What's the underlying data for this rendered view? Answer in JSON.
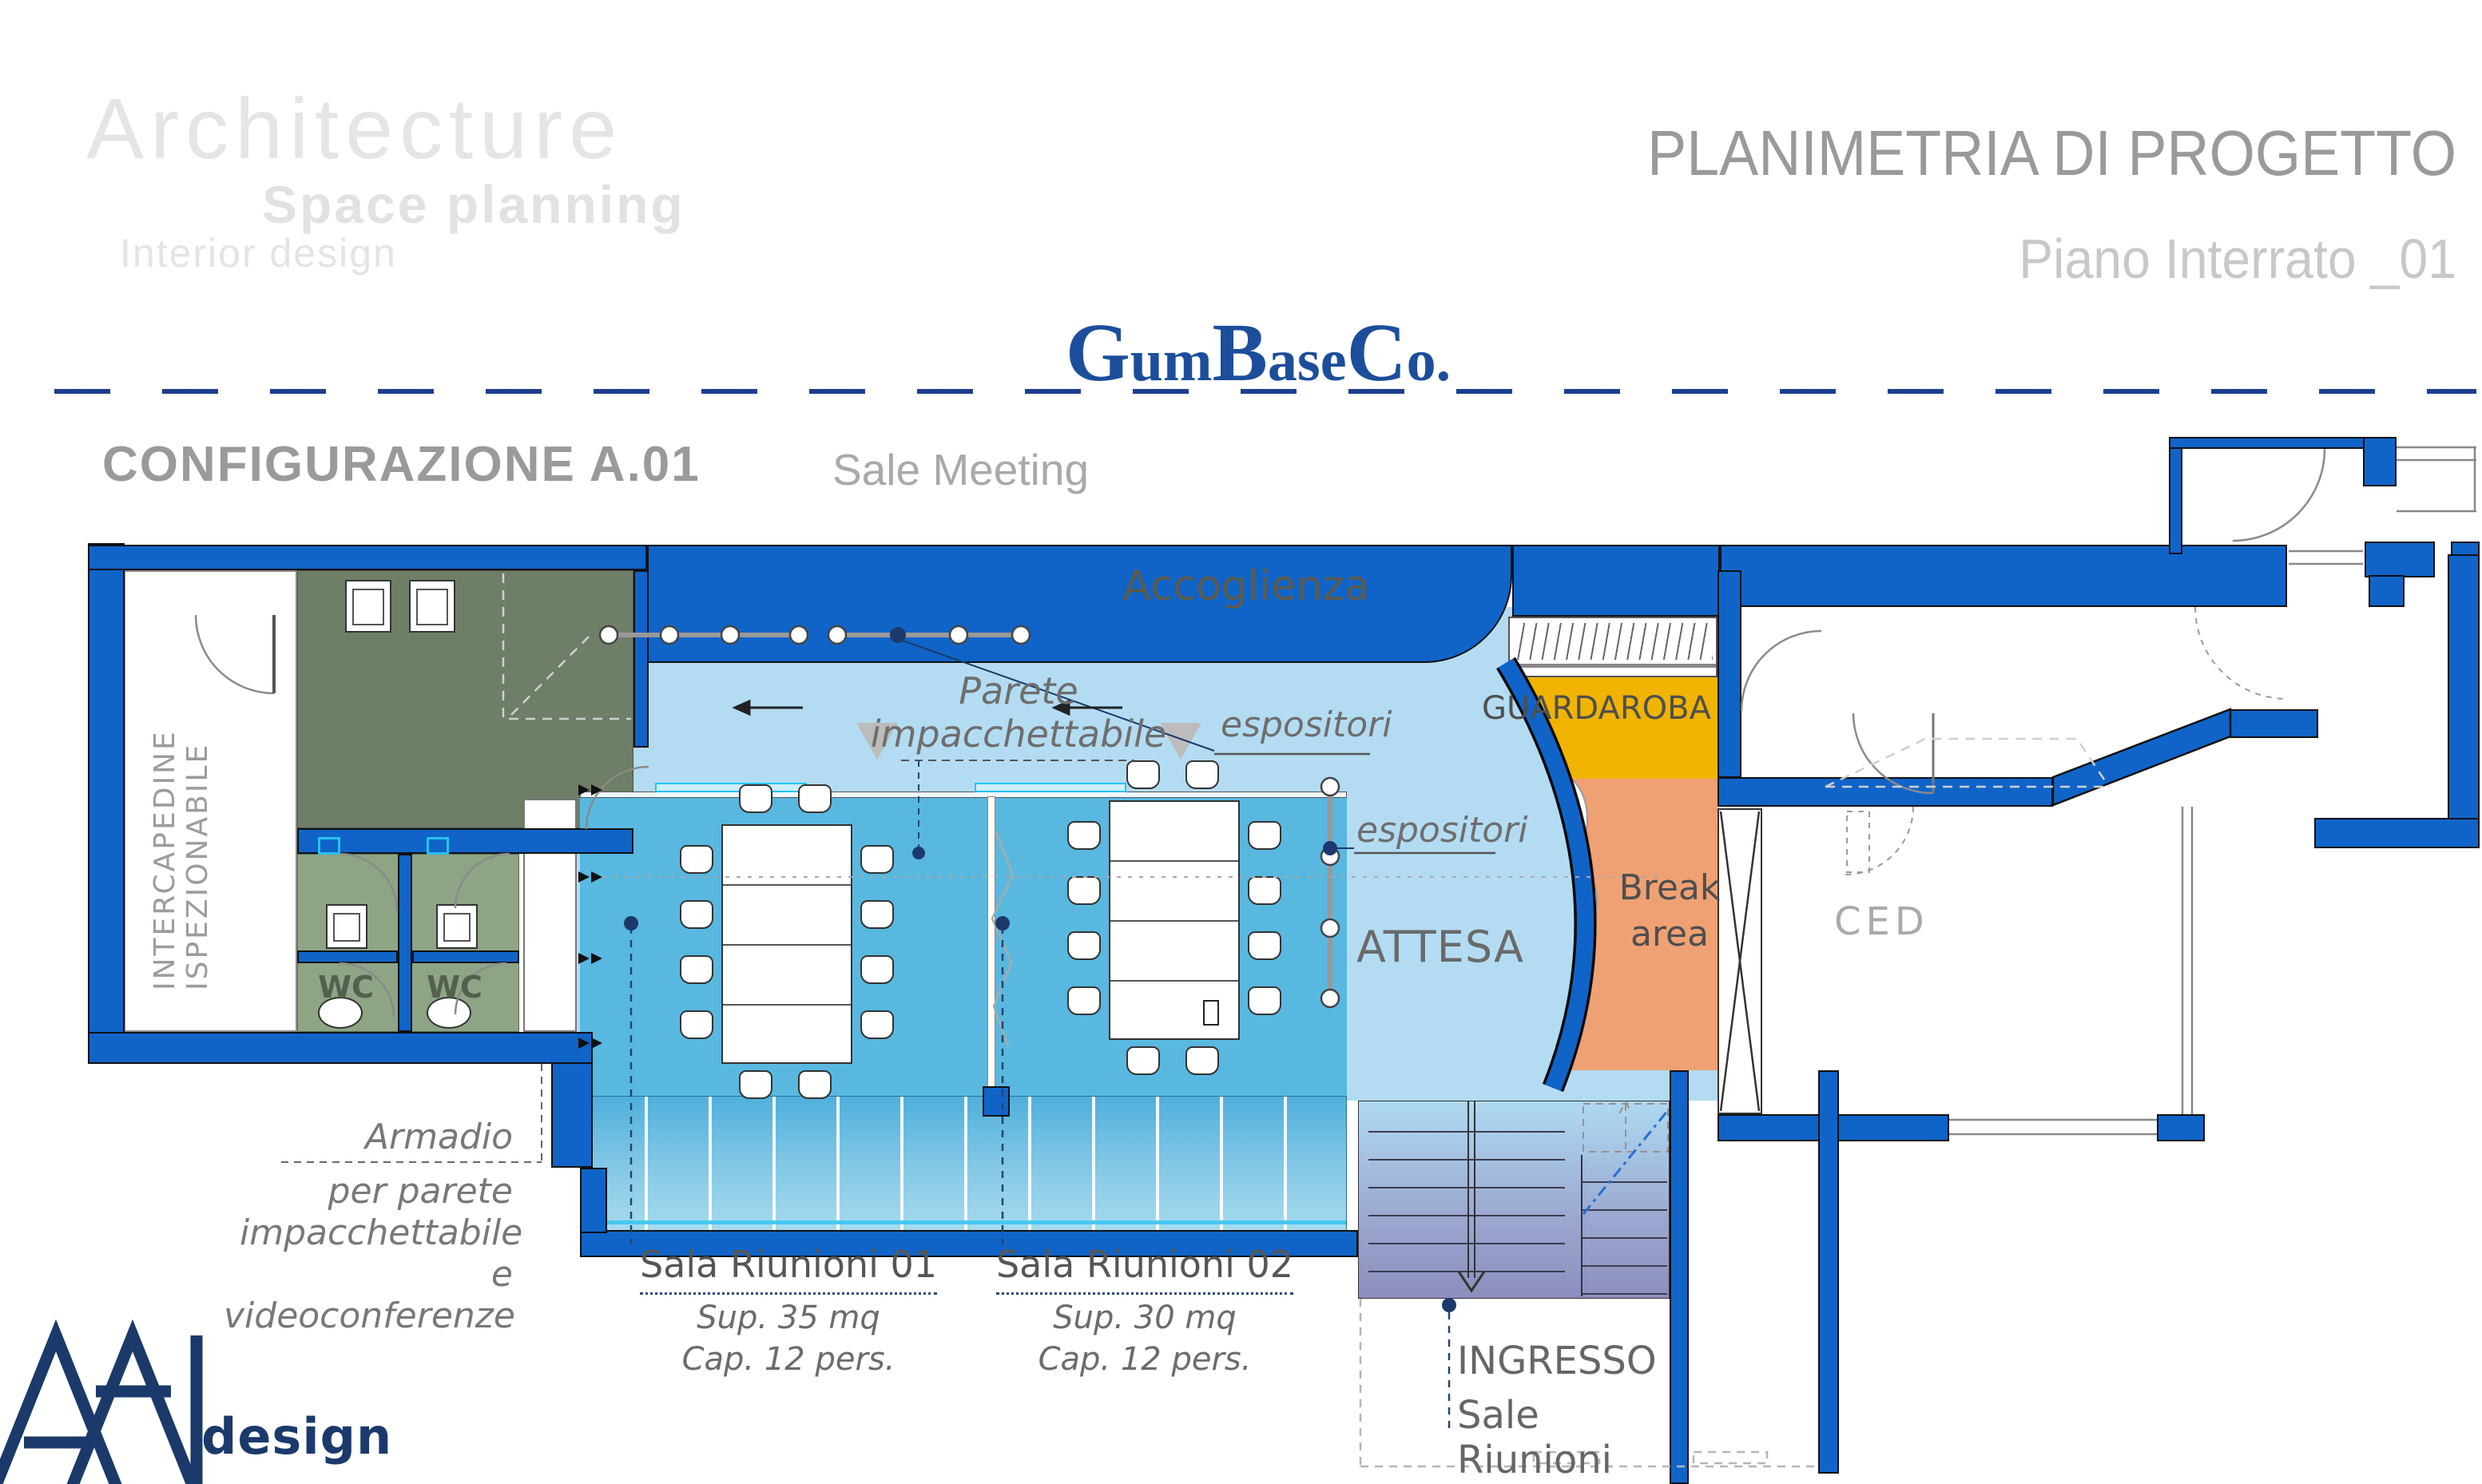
{
  "header": {
    "watermark": {
      "line1": "Architecture",
      "line2": "Space planning",
      "line3": "Interior design"
    },
    "title": "PLANIMETRIA DI PROGETTO",
    "subtitle": "Piano Interrato _01",
    "logo": {
      "p1": "G",
      "p2": "um",
      "p3": "B",
      "p4": "ase",
      "p5": "C",
      "p6": "o."
    },
    "config_code": "CONFIGURAZIONE A.01",
    "config_name": "Sale Meeting"
  },
  "plan": {
    "rooms": {
      "accoglienza": "Accoglienza",
      "intercapedine_line1": "INTERCAPEDINE",
      "intercapedine_line2": "ISPEZIONABILE",
      "wc1": "WC",
      "wc2": "WC",
      "guardaroba": "GUARDAROBA",
      "break_line1": "Break",
      "break_line2": "area",
      "attesa": "ATTESA",
      "ced": "CED"
    },
    "annotations": {
      "parete_line1": "Parete",
      "parete_line2": "impacchettabile",
      "espositori_top": "espositori",
      "espositori_side": "espositori",
      "armadio_line1": "Armadio",
      "armadio_line2": "per parete",
      "armadio_line3": "impacchettabile",
      "armadio_line4": "e",
      "armadio_line5": "videoconferenze",
      "ingresso_line1": "INGRESSO",
      "ingresso_line2": "Sale Riunioni"
    },
    "sala1": {
      "name": "Sala Riunioni 01",
      "sup": "Sup. 35 mq",
      "cap": "Cap. 12 pers."
    },
    "sala2": {
      "name": "Sala Riunioni 02",
      "sup": "Sup. 30 mq",
      "cap": "Cap. 12 pers."
    }
  },
  "brand": {
    "design": "design"
  },
  "colors": {
    "wall_blue": "#1064c8",
    "open_space_blue": "#b3dcf2",
    "meeting_room_blue": "#58b8e0",
    "service_olive": "#6f7e66",
    "wc_green": "#8da585",
    "guardaroba_yellow": "#f0b400",
    "break_orange": "#f0a173",
    "brand_navy": "#1b3a6b",
    "logo_blue": "#1c4e9c",
    "separator_navy": "#1c3f8f"
  }
}
